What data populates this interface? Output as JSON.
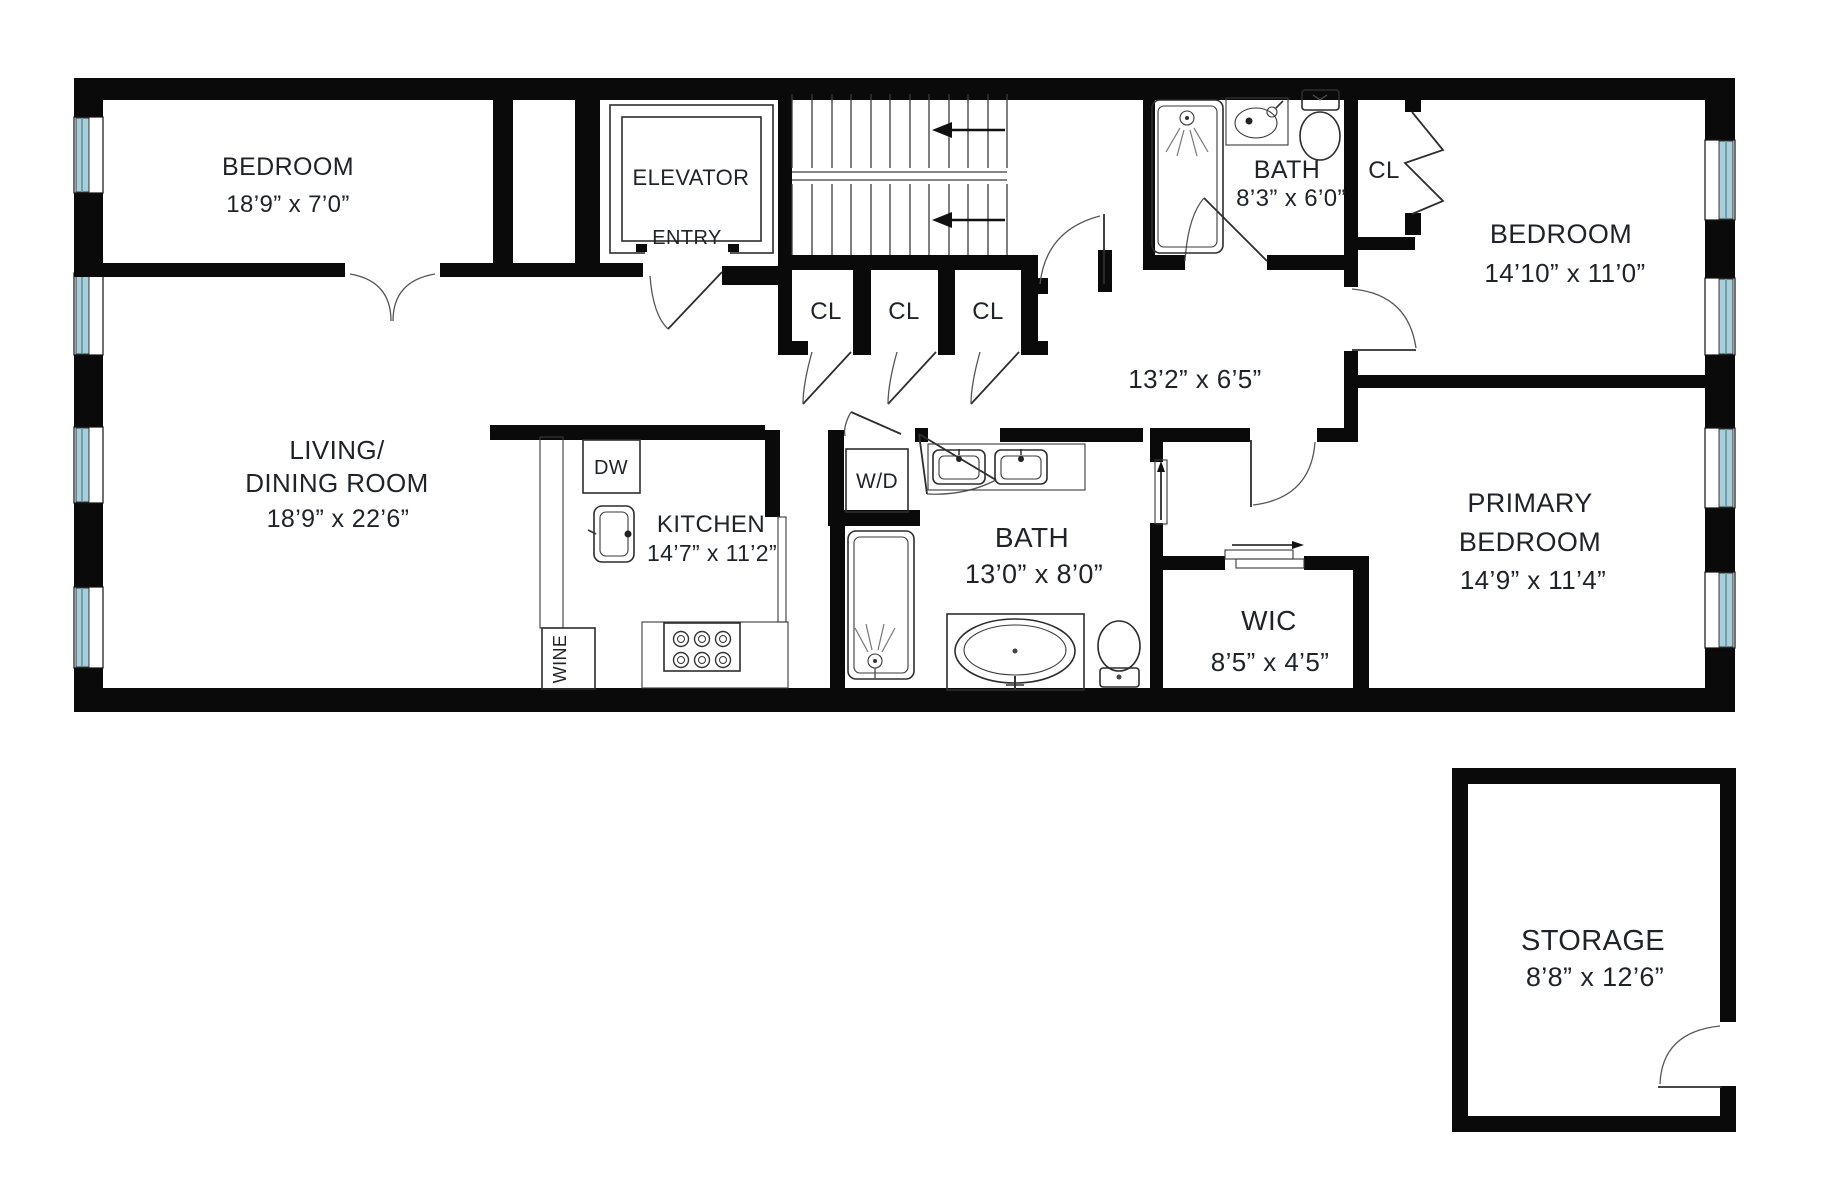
{
  "title": "Floor plan",
  "colors": {
    "wall": "#0a0a0a",
    "line": "#2d2d2d",
    "window_glass": "#a9cdd9",
    "window_glass_dark": "#7fb0c2",
    "text": "#1f2328",
    "background": "#ffffff"
  },
  "rooms": {
    "bedroom1": {
      "name": "BEDROOM",
      "dims": "18’9” x 7’0”"
    },
    "elevator": {
      "name": "ELEVATOR",
      "entry_label": "ENTRY"
    },
    "closet1": {
      "label": "CL"
    },
    "closet2": {
      "label": "CL"
    },
    "closet3": {
      "label": "CL"
    },
    "bath_upper": {
      "name": "BATH",
      "dims": "8’3” x 6’0”"
    },
    "closet_bedroom2": {
      "label": "CL"
    },
    "bedroom2": {
      "name": "BEDROOM",
      "dims": "14’10” x 11’0”"
    },
    "hallway": {
      "dims": "13’2” x 6’5”"
    },
    "living_dining": {
      "name_line1": "LIVING/",
      "name_line2": "DINING ROOM",
      "dims": "18’9” x 22’6”"
    },
    "kitchen": {
      "name": "KITCHEN",
      "dims": "14’7” x 11’2”"
    },
    "bath_main": {
      "name": "BATH",
      "dims": "13’0” x 8’0”"
    },
    "wic": {
      "name": "WIC",
      "dims": "8’5” x 4’5”"
    },
    "primary_bedroom": {
      "name_line1": "PRIMARY",
      "name_line2": "BEDROOM",
      "dims": "14’9” x 11’4”"
    },
    "storage": {
      "name": "STORAGE",
      "dims": "8’8” x 12’6”"
    }
  },
  "appliances": {
    "dishwasher": "DW",
    "wine_cooler": "WINE",
    "washer_dryer": "W/D"
  }
}
